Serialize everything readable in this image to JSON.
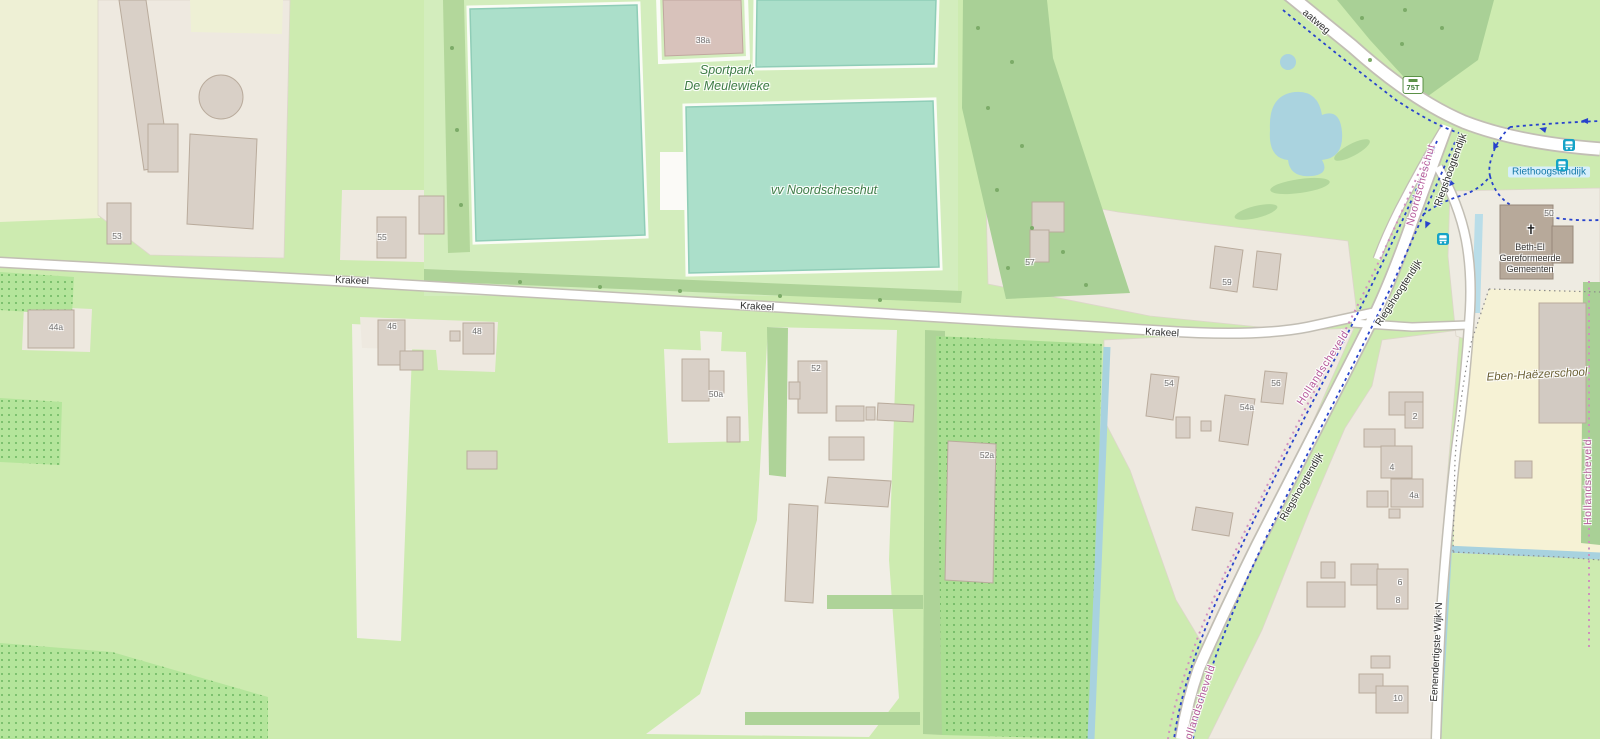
{
  "map": {
    "region_hint": "OpenStreetMap view of Krakeel / Noordscheschut area",
    "colors": {
      "field_green": "#cdebb0",
      "farmland_pale": "#eef0d5",
      "forest_green": "#a9d096",
      "orchard_green": "#aade92",
      "pitch_teal": "#abdfca",
      "water_blue": "#aad3df",
      "residential_gray": "#eee9e0",
      "school_yellow": "#f6f2d5",
      "road_fill": "#ffffff",
      "cycle_route_blue": "#2742cc",
      "boundary_pink": "#cf8fbe"
    },
    "roads": [
      "Krakeel",
      "Riegshoogtendijk",
      "Eenendertigste Wijk-N",
      "aatweg"
    ],
    "boundaries": [
      "Noordscheschut",
      "Hollandscheveld"
    ],
    "pois": {
      "sportpark": "Sportpark De Meulewieke",
      "pitch": "vv Noordscheschut",
      "church": "Beth-El Gereformeerde Gemeenten",
      "church_number": "50",
      "school": "Eben-Haëzerschool",
      "bus_stop": "Riethoogstendijk",
      "cycle_node": "75T"
    }
  },
  "labels": [
    {
      "name": "road-label-aatweg",
      "cls": "road",
      "text": "aatweg",
      "x": 1316,
      "y": 22,
      "rot": 40
    },
    {
      "name": "road-label-krakeel-1",
      "cls": "road",
      "text": "Krakeel",
      "x": 352,
      "y": 281,
      "rot": 2
    },
    {
      "name": "road-label-krakeel-2",
      "cls": "road",
      "text": "Krakeel",
      "x": 757,
      "y": 307,
      "rot": 3
    },
    {
      "name": "road-label-krakeel-3",
      "cls": "road",
      "text": "Krakeel",
      "x": 1162,
      "y": 333,
      "rot": 3
    },
    {
      "name": "road-label-riegshoogtendijk-1",
      "cls": "road",
      "text": "Riegshoogtendijk",
      "x": 1451,
      "y": 170,
      "rot": -70
    },
    {
      "name": "road-label-riegshoogtendijk-2",
      "cls": "road",
      "text": "Riegshoogtendijk",
      "x": 1399,
      "y": 293,
      "rot": -57
    },
    {
      "name": "road-label-riegshoogtendijk-3",
      "cls": "road",
      "text": "Riegshoogtendijk",
      "x": 1302,
      "y": 487,
      "rot": -60
    },
    {
      "name": "road-label-eenendertigste-wijk-n",
      "cls": "road",
      "text": "Eenendertigste Wijk-N",
      "x": 1437,
      "y": 652,
      "rot": -87
    },
    {
      "name": "place-label-sportpark-line1",
      "cls": "place",
      "text": "Sportpark",
      "x": 727,
      "y": 70,
      "rot": 0
    },
    {
      "name": "place-label-sportpark-line2",
      "cls": "place",
      "text": "De Meulewieke",
      "x": 727,
      "y": 86,
      "rot": 0
    },
    {
      "name": "place-label-vv-noordscheschut",
      "cls": "place",
      "text": "vv Noordscheschut",
      "x": 824,
      "y": 190,
      "rot": 0
    },
    {
      "name": "place-label-school",
      "cls": "school",
      "text": "Eben-Haëzerschool",
      "x": 1537,
      "y": 375,
      "rot": -3
    },
    {
      "name": "church-label-line1",
      "cls": "church",
      "text": "Beth-El",
      "x": 1530,
      "y": 247,
      "rot": 0
    },
    {
      "name": "church-label-line2",
      "cls": "church",
      "text": "Gereformeerde",
      "x": 1530,
      "y": 258,
      "rot": 0
    },
    {
      "name": "church-label-line3",
      "cls": "church",
      "text": "Gemeenten",
      "x": 1530,
      "y": 269,
      "rot": 0
    },
    {
      "name": "church-cross-icon",
      "cls": "cross",
      "text": "✝",
      "x": 1531,
      "y": 230,
      "rot": 0
    },
    {
      "name": "bus-stop-name",
      "cls": "busname",
      "text": "Riethoogstendijk",
      "x": 1549,
      "y": 172,
      "rot": 0
    },
    {
      "name": "cycle-node-badge",
      "cls": "badge75",
      "text": "75T",
      "x": 1413,
      "y": 85,
      "rot": 0
    },
    {
      "name": "boundary-label-noordscheschut",
      "cls": "boundary",
      "text": "Noordscheschut",
      "x": 1421,
      "y": 185,
      "rot": -75
    },
    {
      "name": "boundary-label-hollandscheveld-1",
      "cls": "boundary",
      "text": "Hollandscheveld",
      "x": 1323,
      "y": 368,
      "rot": -57
    },
    {
      "name": "boundary-label-hollandscheveld-2",
      "cls": "boundary",
      "text": "Hollandscheveld",
      "x": 1199,
      "y": 706,
      "rot": -72
    },
    {
      "name": "boundary-label-hollandscheveld-3",
      "cls": "boundary",
      "text": "Hollandscheveld",
      "x": 1588,
      "y": 482,
      "rot": -90
    },
    {
      "name": "housenumber-38a",
      "cls": "housenum",
      "text": "38a",
      "x": 703,
      "y": 40,
      "rot": 0
    },
    {
      "name": "housenumber-53",
      "cls": "housenum",
      "text": "53",
      "x": 117,
      "y": 236,
      "rot": 0
    },
    {
      "name": "housenumber-55",
      "cls": "housenum",
      "text": "55",
      "x": 382,
      "y": 237,
      "rot": 0
    },
    {
      "name": "housenumber-44a",
      "cls": "housenum",
      "text": "44a",
      "x": 56,
      "y": 327,
      "rot": 0
    },
    {
      "name": "housenumber-46",
      "cls": "housenum",
      "text": "46",
      "x": 392,
      "y": 326,
      "rot": 0
    },
    {
      "name": "housenumber-48",
      "cls": "housenum",
      "text": "48",
      "x": 477,
      "y": 331,
      "rot": 0
    },
    {
      "name": "housenumber-50a",
      "cls": "housenum",
      "text": "50a",
      "x": 716,
      "y": 394,
      "rot": 0
    },
    {
      "name": "housenumber-52",
      "cls": "housenum",
      "text": "52",
      "x": 816,
      "y": 368,
      "rot": 0
    },
    {
      "name": "housenumber-52a",
      "cls": "housenum",
      "text": "52a",
      "x": 987,
      "y": 455,
      "rot": 0
    },
    {
      "name": "housenumber-57",
      "cls": "housenum",
      "text": "57",
      "x": 1030,
      "y": 262,
      "rot": 0
    },
    {
      "name": "housenumber-59",
      "cls": "housenum",
      "text": "59",
      "x": 1227,
      "y": 282,
      "rot": 0
    },
    {
      "name": "housenumber-54",
      "cls": "housenum",
      "text": "54",
      "x": 1169,
      "y": 383,
      "rot": 0
    },
    {
      "name": "housenumber-56",
      "cls": "housenum",
      "text": "56",
      "x": 1276,
      "y": 383,
      "rot": 0
    },
    {
      "name": "housenumber-54a",
      "cls": "housenum",
      "text": "54a",
      "x": 1247,
      "y": 407,
      "rot": 0
    },
    {
      "name": "housenumber-50",
      "cls": "housenum",
      "text": "50",
      "x": 1549,
      "y": 213,
      "rot": 0
    },
    {
      "name": "housenumber-2",
      "cls": "housenum",
      "text": "2",
      "x": 1415,
      "y": 416,
      "rot": 0
    },
    {
      "name": "housenumber-4",
      "cls": "housenum",
      "text": "4",
      "x": 1392,
      "y": 467,
      "rot": 0
    },
    {
      "name": "housenumber-4a",
      "cls": "housenum",
      "text": "4a",
      "x": 1414,
      "y": 495,
      "rot": 0
    },
    {
      "name": "housenumber-6",
      "cls": "housenum",
      "text": "6",
      "x": 1400,
      "y": 582,
      "rot": 0
    },
    {
      "name": "housenumber-8",
      "cls": "housenum",
      "text": "8",
      "x": 1398,
      "y": 600,
      "rot": 0
    },
    {
      "name": "housenumber-10",
      "cls": "housenum",
      "text": "10",
      "x": 1398,
      "y": 698,
      "rot": 0
    }
  ],
  "icons": {
    "bus_stops": [
      {
        "name": "bus-stop-icon",
        "x": 1569,
        "y": 145
      },
      {
        "name": "bus-stop-icon",
        "x": 1562,
        "y": 165
      },
      {
        "name": "bus-stop-icon",
        "x": 1443,
        "y": 239
      }
    ]
  }
}
